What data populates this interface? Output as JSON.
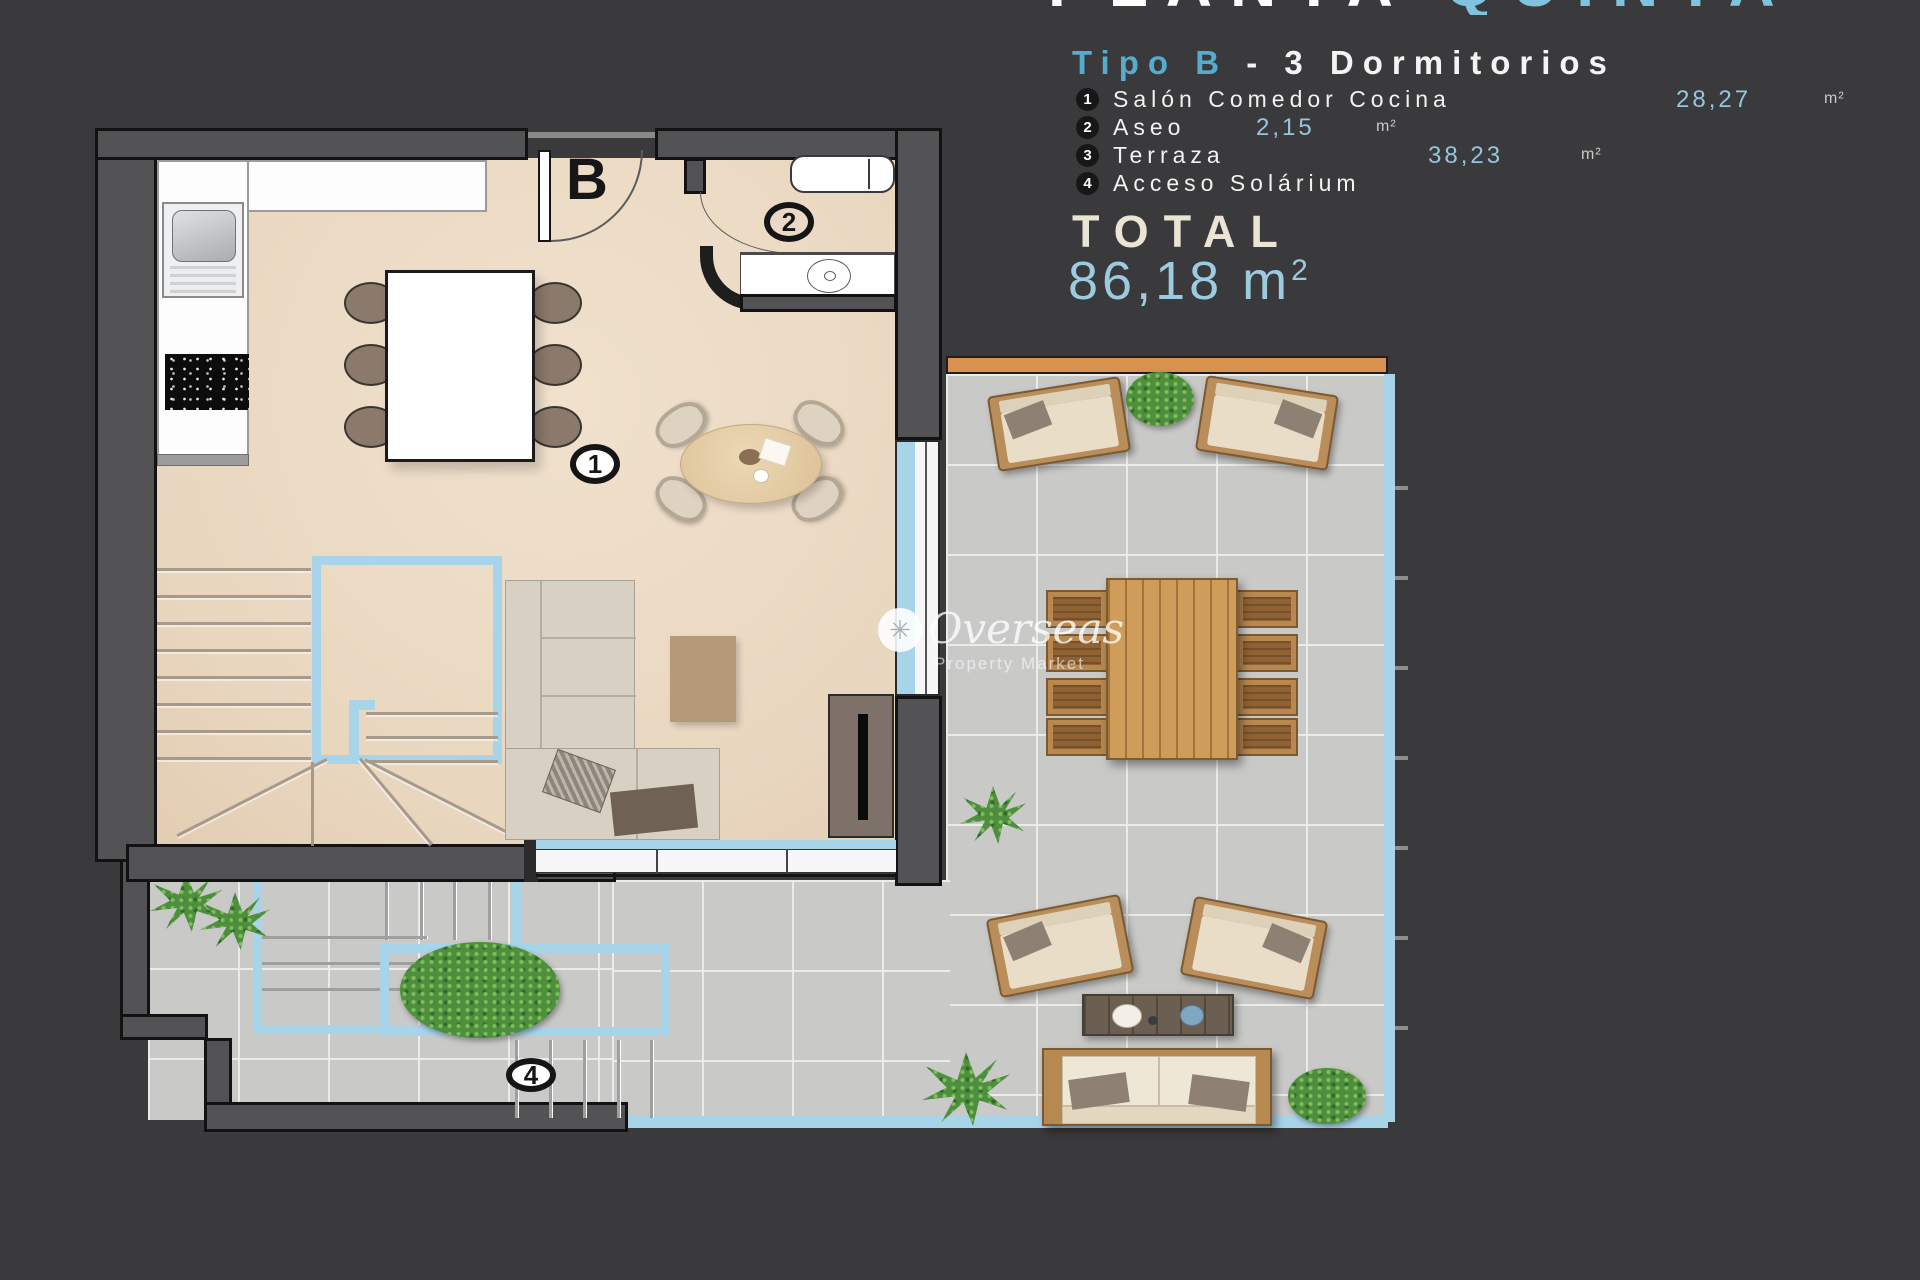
{
  "header": {
    "title_part1": "PLANTA",
    "title_part2": "QUINTA",
    "subtitle_type": "Tipo B",
    "subtitle_rest": " - 3  Dormitorios"
  },
  "legend": {
    "items": [
      {
        "num": "1",
        "label": "Salón Comedor Cocina",
        "area": "28,27",
        "unit": "m²"
      },
      {
        "num": "2",
        "label": "Aseo",
        "area": "2,15",
        "unit": "m²"
      },
      {
        "num": "3",
        "label": "Terraza",
        "area": "38,23",
        "unit": "m²"
      },
      {
        "num": "4",
        "label": "Acceso Solárium",
        "area": "",
        "unit": ""
      }
    ]
  },
  "total": {
    "label": "TOTAL",
    "value": "86,18",
    "unit": "m",
    "sup": "2"
  },
  "plan": {
    "door_label": "B",
    "room1_label": "1",
    "room2_label": "2",
    "room4_label": "4"
  },
  "watermark": {
    "icon": "✳",
    "name": "Overseas",
    "tagline": "Property Market"
  },
  "colors": {
    "background": "#3a393b",
    "accent_blue_text": "#55accf",
    "value_blue": "#93c7de",
    "cream": "#eae4d4",
    "floor_beige": "#ecdbc7",
    "tile_gray": "#c9c9c8",
    "rail_blue": "#a8d4ea",
    "wood": "#cf9c59",
    "wall": "#535255",
    "deck_orange": "#d8914f"
  }
}
